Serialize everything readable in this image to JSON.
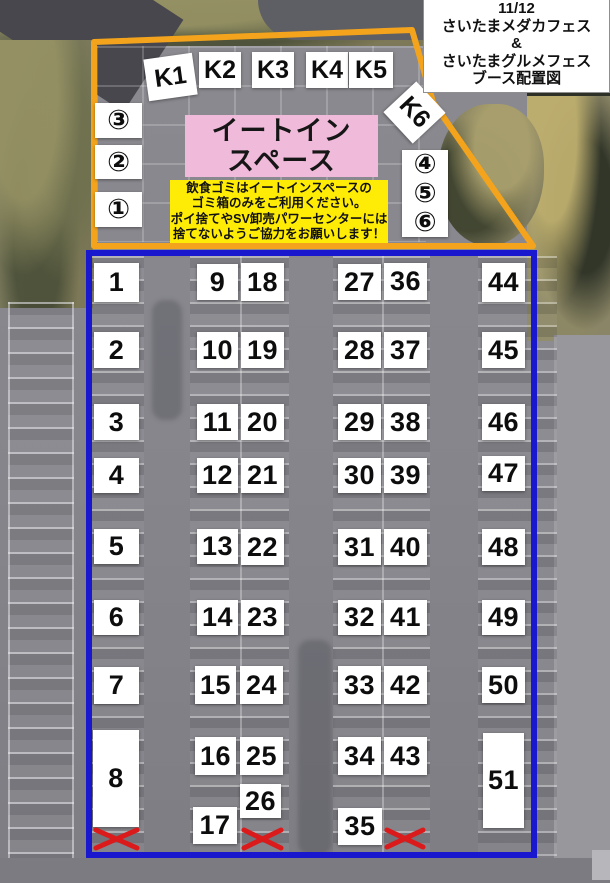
{
  "title_box": {
    "lines": [
      "11/12",
      "さいたまメダカフェス",
      "&",
      "さいたまグルメフェス",
      "ブース配置図"
    ]
  },
  "eatin_space": {
    "line1": "イートイン",
    "line2": "スペース"
  },
  "notice": {
    "lines": [
      "飲食ゴミはイートインスペースの",
      "ゴミ箱のみをご利用ください。",
      "ポイ捨てやSV卸売パワーセンターには",
      "捨てないようご協力をお願いします！"
    ]
  },
  "left_circles": {
    "labels": [
      "③",
      "②",
      "①"
    ]
  },
  "right_circles": {
    "labels": [
      "④",
      "⑤",
      "⑥"
    ]
  },
  "kiosks": [
    {
      "label": "K1",
      "x": 146,
      "y": 56,
      "w": 49,
      "h": 42,
      "rot": -8
    },
    {
      "label": "K2",
      "x": 199,
      "y": 52,
      "w": 42,
      "h": 36,
      "rot": 0
    },
    {
      "label": "K3",
      "x": 252,
      "y": 52,
      "w": 42,
      "h": 36,
      "rot": 0
    },
    {
      "label": "K4",
      "x": 306,
      "y": 52,
      "w": 42,
      "h": 36,
      "rot": 0
    },
    {
      "label": "K5",
      "x": 349,
      "y": 52,
      "w": 44,
      "h": 36,
      "rot": 0
    },
    {
      "label": "K6",
      "x": 393,
      "y": 90,
      "w": 43,
      "h": 45,
      "rot": 47
    }
  ],
  "booths": [
    {
      "label": "1",
      "x": 94,
      "y": 263,
      "w": 45,
      "h": 39
    },
    {
      "label": "2",
      "x": 94,
      "y": 332,
      "w": 45,
      "h": 36
    },
    {
      "label": "3",
      "x": 94,
      "y": 404,
      "w": 45,
      "h": 36
    },
    {
      "label": "4",
      "x": 94,
      "y": 458,
      "w": 45,
      "h": 35
    },
    {
      "label": "5",
      "x": 94,
      "y": 529,
      "w": 45,
      "h": 35
    },
    {
      "label": "6",
      "x": 94,
      "y": 600,
      "w": 45,
      "h": 35
    },
    {
      "label": "7",
      "x": 94,
      "y": 667,
      "w": 45,
      "h": 37
    },
    {
      "label": "8",
      "x": 93,
      "y": 730,
      "w": 46,
      "h": 97
    },
    {
      "label": "9",
      "x": 197,
      "y": 264,
      "w": 41,
      "h": 36
    },
    {
      "label": "10",
      "x": 197,
      "y": 332,
      "w": 41,
      "h": 36
    },
    {
      "label": "11",
      "x": 197,
      "y": 404,
      "w": 41,
      "h": 36
    },
    {
      "label": "12",
      "x": 197,
      "y": 458,
      "w": 41,
      "h": 35
    },
    {
      "label": "13",
      "x": 197,
      "y": 529,
      "w": 41,
      "h": 35
    },
    {
      "label": "14",
      "x": 197,
      "y": 600,
      "w": 41,
      "h": 35
    },
    {
      "label": "15",
      "x": 195,
      "y": 666,
      "w": 41,
      "h": 38
    },
    {
      "label": "16",
      "x": 195,
      "y": 737,
      "w": 41,
      "h": 38
    },
    {
      "label": "17",
      "x": 193,
      "y": 807,
      "w": 44,
      "h": 37
    },
    {
      "label": "18",
      "x": 241,
      "y": 263,
      "w": 43,
      "h": 38
    },
    {
      "label": "19",
      "x": 241,
      "y": 332,
      "w": 43,
      "h": 36
    },
    {
      "label": "20",
      "x": 241,
      "y": 404,
      "w": 43,
      "h": 36
    },
    {
      "label": "21",
      "x": 241,
      "y": 458,
      "w": 43,
      "h": 35
    },
    {
      "label": "22",
      "x": 241,
      "y": 529,
      "w": 43,
      "h": 36
    },
    {
      "label": "23",
      "x": 241,
      "y": 600,
      "w": 43,
      "h": 35
    },
    {
      "label": "24",
      "x": 240,
      "y": 666,
      "w": 43,
      "h": 38
    },
    {
      "label": "25",
      "x": 240,
      "y": 737,
      "w": 43,
      "h": 38
    },
    {
      "label": "26",
      "x": 240,
      "y": 784,
      "w": 41,
      "h": 34
    },
    {
      "label": "27",
      "x": 338,
      "y": 264,
      "w": 43,
      "h": 36
    },
    {
      "label": "28",
      "x": 338,
      "y": 332,
      "w": 43,
      "h": 36
    },
    {
      "label": "29",
      "x": 338,
      "y": 404,
      "w": 43,
      "h": 36
    },
    {
      "label": "30",
      "x": 338,
      "y": 458,
      "w": 43,
      "h": 35
    },
    {
      "label": "31",
      "x": 338,
      "y": 529,
      "w": 43,
      "h": 36
    },
    {
      "label": "32",
      "x": 338,
      "y": 600,
      "w": 43,
      "h": 35
    },
    {
      "label": "33",
      "x": 338,
      "y": 666,
      "w": 43,
      "h": 38
    },
    {
      "label": "34",
      "x": 338,
      "y": 737,
      "w": 43,
      "h": 38
    },
    {
      "label": "35",
      "x": 338,
      "y": 808,
      "w": 44,
      "h": 37
    },
    {
      "label": "36",
      "x": 384,
      "y": 263,
      "w": 43,
      "h": 37
    },
    {
      "label": "37",
      "x": 384,
      "y": 332,
      "w": 43,
      "h": 36
    },
    {
      "label": "38",
      "x": 384,
      "y": 404,
      "w": 43,
      "h": 36
    },
    {
      "label": "39",
      "x": 384,
      "y": 458,
      "w": 43,
      "h": 35
    },
    {
      "label": "40",
      "x": 384,
      "y": 529,
      "w": 43,
      "h": 36
    },
    {
      "label": "41",
      "x": 384,
      "y": 600,
      "w": 43,
      "h": 35
    },
    {
      "label": "42",
      "x": 384,
      "y": 666,
      "w": 43,
      "h": 38
    },
    {
      "label": "43",
      "x": 384,
      "y": 737,
      "w": 43,
      "h": 38
    },
    {
      "label": "44",
      "x": 482,
      "y": 263,
      "w": 43,
      "h": 39
    },
    {
      "label": "45",
      "x": 482,
      "y": 332,
      "w": 43,
      "h": 36
    },
    {
      "label": "46",
      "x": 482,
      "y": 404,
      "w": 43,
      "h": 36
    },
    {
      "label": "47",
      "x": 482,
      "y": 456,
      "w": 43,
      "h": 35
    },
    {
      "label": "48",
      "x": 482,
      "y": 529,
      "w": 43,
      "h": 36
    },
    {
      "label": "49",
      "x": 482,
      "y": 600,
      "w": 43,
      "h": 35
    },
    {
      "label": "50",
      "x": 482,
      "y": 667,
      "w": 43,
      "h": 36
    },
    {
      "label": "51",
      "x": 483,
      "y": 733,
      "w": 41,
      "h": 95
    }
  ],
  "x_marks": [
    {
      "x": 93,
      "y": 827,
      "w": 47,
      "h": 24
    },
    {
      "x": 241,
      "y": 827,
      "w": 43,
      "h": 24
    },
    {
      "x": 384,
      "y": 827,
      "w": 42,
      "h": 23
    }
  ],
  "colors": {
    "orange_outline": "#f3a41c",
    "blue_outline": "#1a18ce",
    "red_x": "#db1b1b",
    "eatin_pink": "#f0bbda",
    "notice_yellow": "#ffec06"
  }
}
